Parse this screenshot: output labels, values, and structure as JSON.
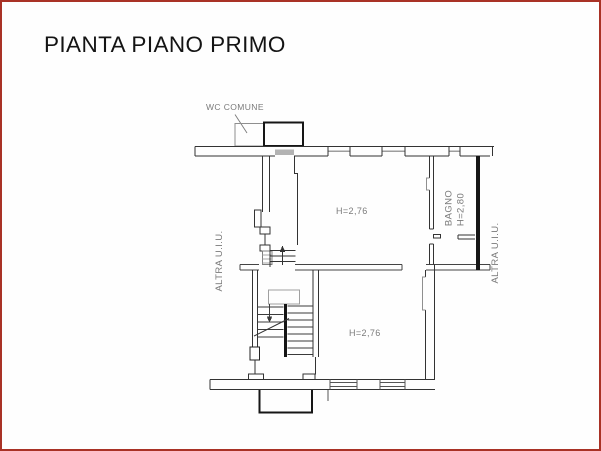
{
  "page": {
    "title": "PIANTA PIANO PRIMO"
  },
  "plan": {
    "labels": {
      "wc_common": "WC COMUNE",
      "upper_room_height": "H=2,76",
      "lower_room_height": "H=2,76",
      "bathroom_name": "BAGNO",
      "bathroom_height": "H=2,80",
      "other_unit_left": "ALTRA U.I.U.",
      "other_unit_right": "ALTRA U.I.U."
    },
    "colors": {
      "page_border": "#a93226",
      "wall_thin": "#333333",
      "wall_heavy": "#161616",
      "window_gray": "#9e9e9e",
      "label_gray": "#7a7a7a",
      "background": "#fefefe"
    }
  }
}
